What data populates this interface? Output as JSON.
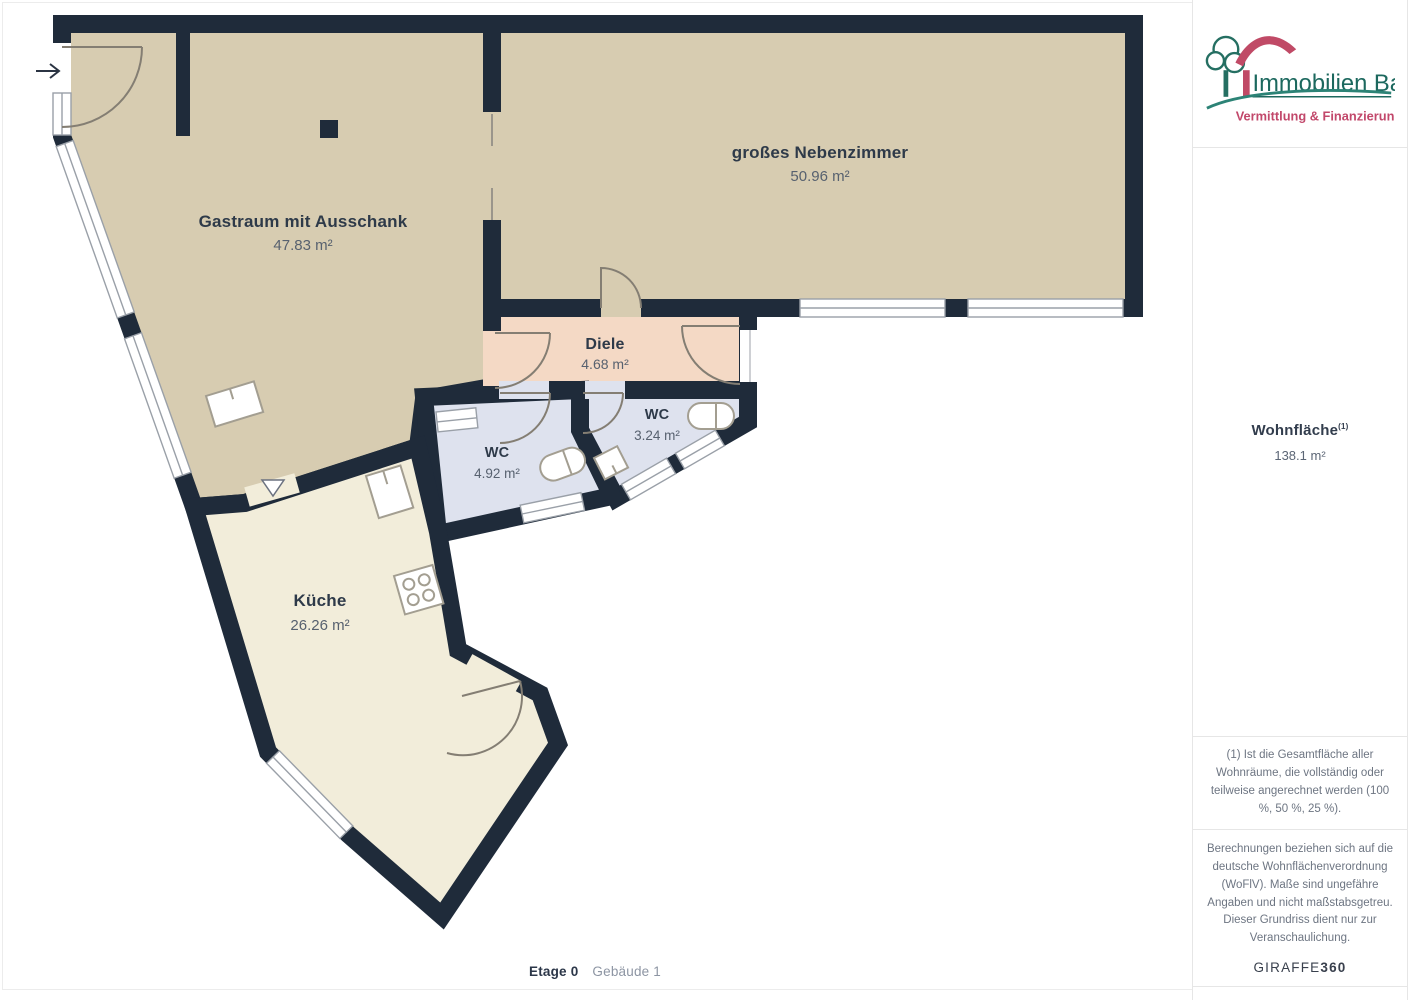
{
  "logo": {
    "title": "Immobilien Bart",
    "subtitle": "Vermittlung & Finanzierung"
  },
  "sidebar": {
    "area_title": "Wohnfläche",
    "area_marker": "(1)",
    "area_value": "138.1 m²",
    "footnote": "(1) Ist die Gesamtfläche aller Wohnräume, die vollständig oder teilweise angerechnet werden (100 %, 50 %, 25 %).",
    "disclaimer": "Berechnungen beziehen sich auf die deutsche Wohnflächenverordnung (WoFlV). Maße sind ungefähre Angaben und nicht maßstabsgetreu. Dieser Grundriss dient nur zur Veranschaulichung.",
    "brand_name": "GIRAFFE",
    "brand_suffix": "360"
  },
  "plan": {
    "rooms": [
      {
        "name": "Gastraum mit Ausschank",
        "area": "47.83 m²"
      },
      {
        "name": "großes Nebenzimmer",
        "area": "50.96 m²"
      },
      {
        "name": "Diele",
        "area": "4.68 m²"
      },
      {
        "name": "WC",
        "area": "3.24 m²"
      },
      {
        "name": "WC",
        "area": "4.92 m²"
      },
      {
        "name": "Küche",
        "area": "26.26 m²"
      }
    ]
  },
  "caption": {
    "floor": "Etage 0",
    "building": "Gebäude 1"
  },
  "colors": {
    "wall": "#1f2b3a",
    "room_tan": "#d7ccb1",
    "room_pink": "#f4d9c5",
    "room_lavender": "#dee2ee",
    "room_cream": "#f2edda",
    "logo_green": "#21695e",
    "logo_red": "#c04a66",
    "text_dark": "#2e3a49",
    "text_muted": "#57616f"
  }
}
